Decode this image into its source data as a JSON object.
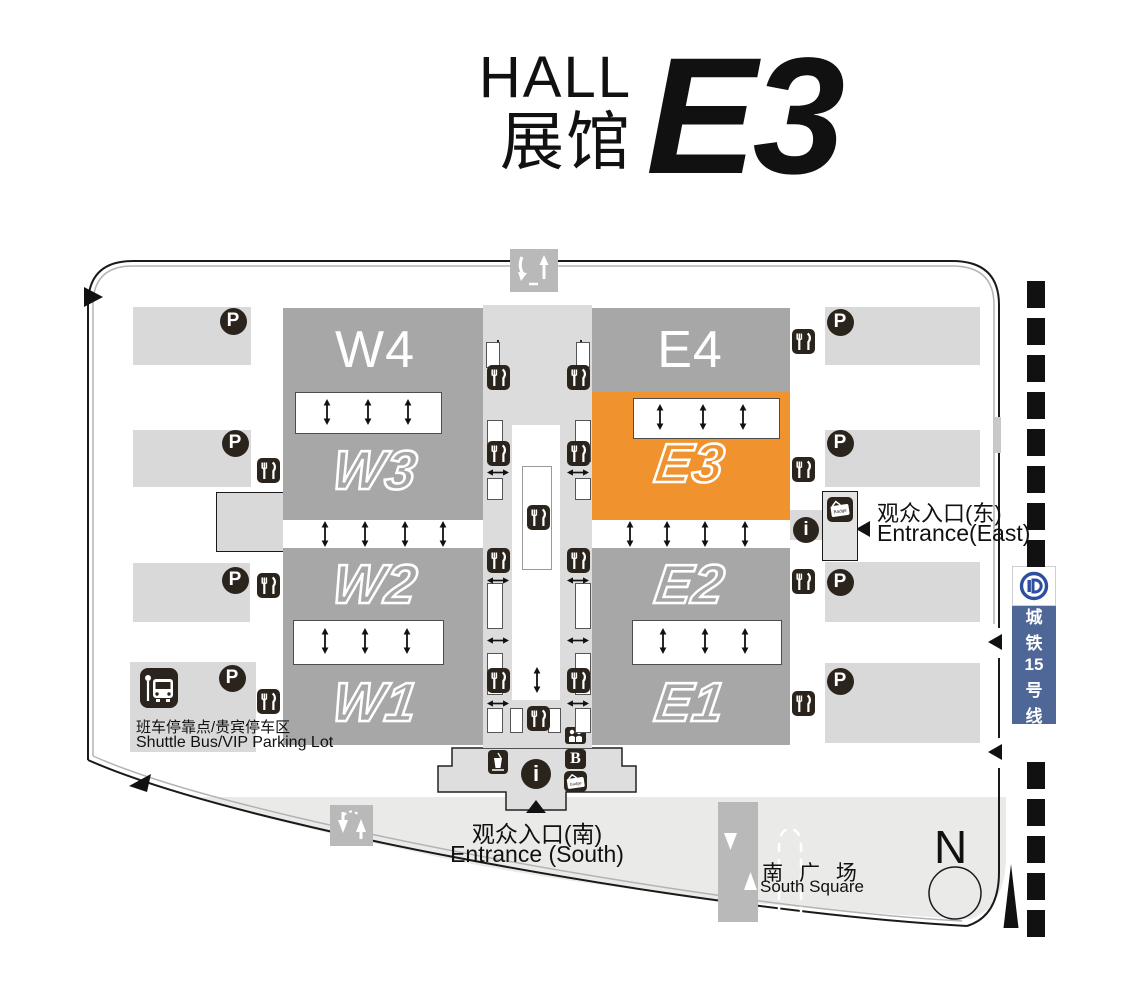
{
  "title": {
    "hall_en": "HALL",
    "hall_zh": "展馆",
    "hall_code": "E3"
  },
  "halls": [
    {
      "id": "w4",
      "label": "W4",
      "style": "solid",
      "highlighted": false
    },
    {
      "id": "w3",
      "label": "W3",
      "style": "outline",
      "highlighted": false
    },
    {
      "id": "w2",
      "label": "W2",
      "style": "outline",
      "highlighted": false
    },
    {
      "id": "w1",
      "label": "W1",
      "style": "outline",
      "highlighted": false
    },
    {
      "id": "e4",
      "label": "E4",
      "style": "solid",
      "highlighted": false
    },
    {
      "id": "e3",
      "label": "E3",
      "style": "outline",
      "highlighted": true
    },
    {
      "id": "e2",
      "label": "E2",
      "style": "outline",
      "highlighted": false
    },
    {
      "id": "e1",
      "label": "E1",
      "style": "outline",
      "highlighted": false
    }
  ],
  "entrances": {
    "south": {
      "zh": "观众入口(南)",
      "en": "Entrance (South)"
    },
    "east": {
      "zh": "观众入口(东)",
      "en": "Entrance(East)"
    }
  },
  "shuttle": {
    "zh": "班车停靠点/贵宾停车区",
    "en": "Shuttle Bus/VIP Parking Lot"
  },
  "south_square": {
    "zh": "南 广 场",
    "en": "South Square"
  },
  "metro": {
    "name": "城铁15号线",
    "chars": [
      "城",
      "铁",
      "15",
      "号",
      "线"
    ]
  },
  "compass": {
    "north": "N"
  },
  "icons": {
    "parking": "P",
    "baggage": "B",
    "badge_label": "Badge",
    "restaurant": "fork-and-knife",
    "info": "i",
    "bus": "shuttle-bus",
    "drink": "beverage",
    "people": "reception"
  },
  "colors": {
    "highlight_orange": "#f0922d",
    "hall_gray": "#a7a7a7",
    "parking_gray": "#d9d9d9",
    "corridor_gray": "#dcdcdc",
    "square_gray": "#eaeae8",
    "road_gray": "#b9b9b9",
    "icon_dark": "#2b241d",
    "metro_blue": "#4e6796"
  }
}
